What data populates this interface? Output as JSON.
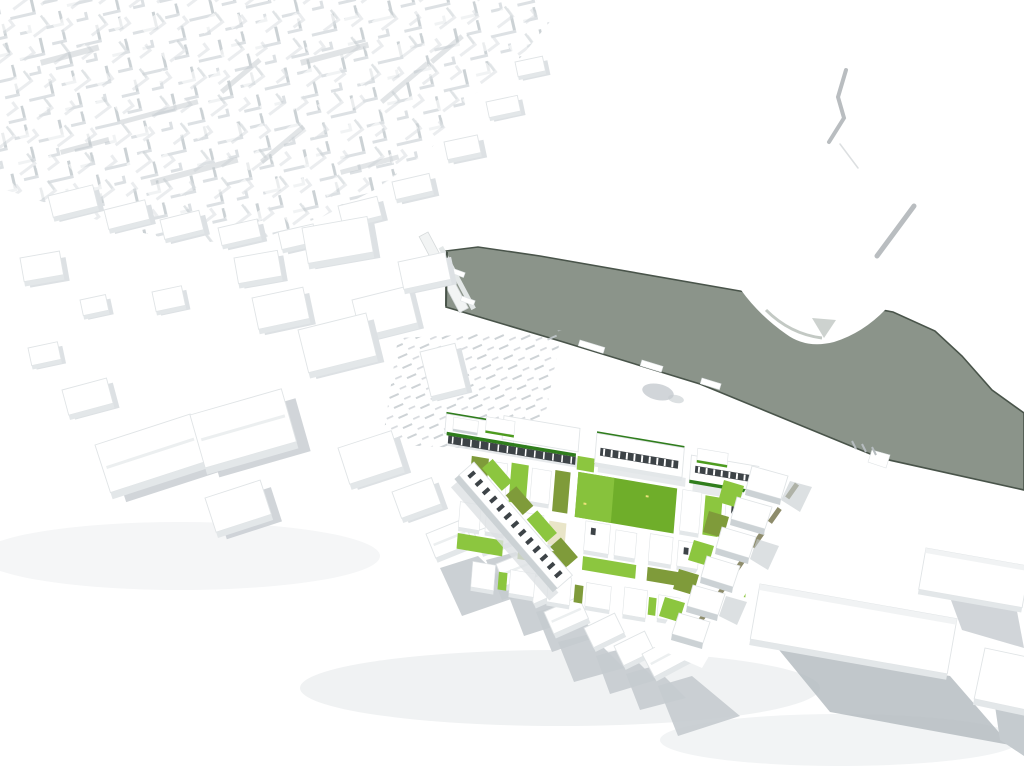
{
  "scene": {
    "type": "3D architectural massing model render",
    "view": "aerial oblique",
    "regions": [
      "city-fabric-northwest",
      "river-canal",
      "lock-weir",
      "riverbank-peninsula",
      "embankment-lines",
      "quayside",
      "parking-lot-striping",
      "development-site",
      "green-courtyards",
      "boulevard-road",
      "existing-buildings-west",
      "existing-buildings-south",
      "warehouses-southeast"
    ]
  },
  "colors": {
    "background": "#ffffff",
    "water": "#8b948a",
    "water_edge": "#49544a",
    "outline": "#e0e4e6",
    "face": "#e3e7e9",
    "face_dark": "#ccd2d5",
    "shadow_soft": "#dde1e4",
    "shadow_mid": "#c5cbcf",
    "shadow_dark": "#b2b9be",
    "window_void": "#3d4347",
    "lawn_green": "#6fae2a",
    "bright_green": "#8cc63f",
    "olive_green": "#7f9b3a",
    "dark_green": "#2f7d1c",
    "leaf_green": "#4d9c1e",
    "road_median": "#8e8c6b",
    "cream": "#e9e5c8",
    "marker_yellow": "#ece27a"
  }
}
